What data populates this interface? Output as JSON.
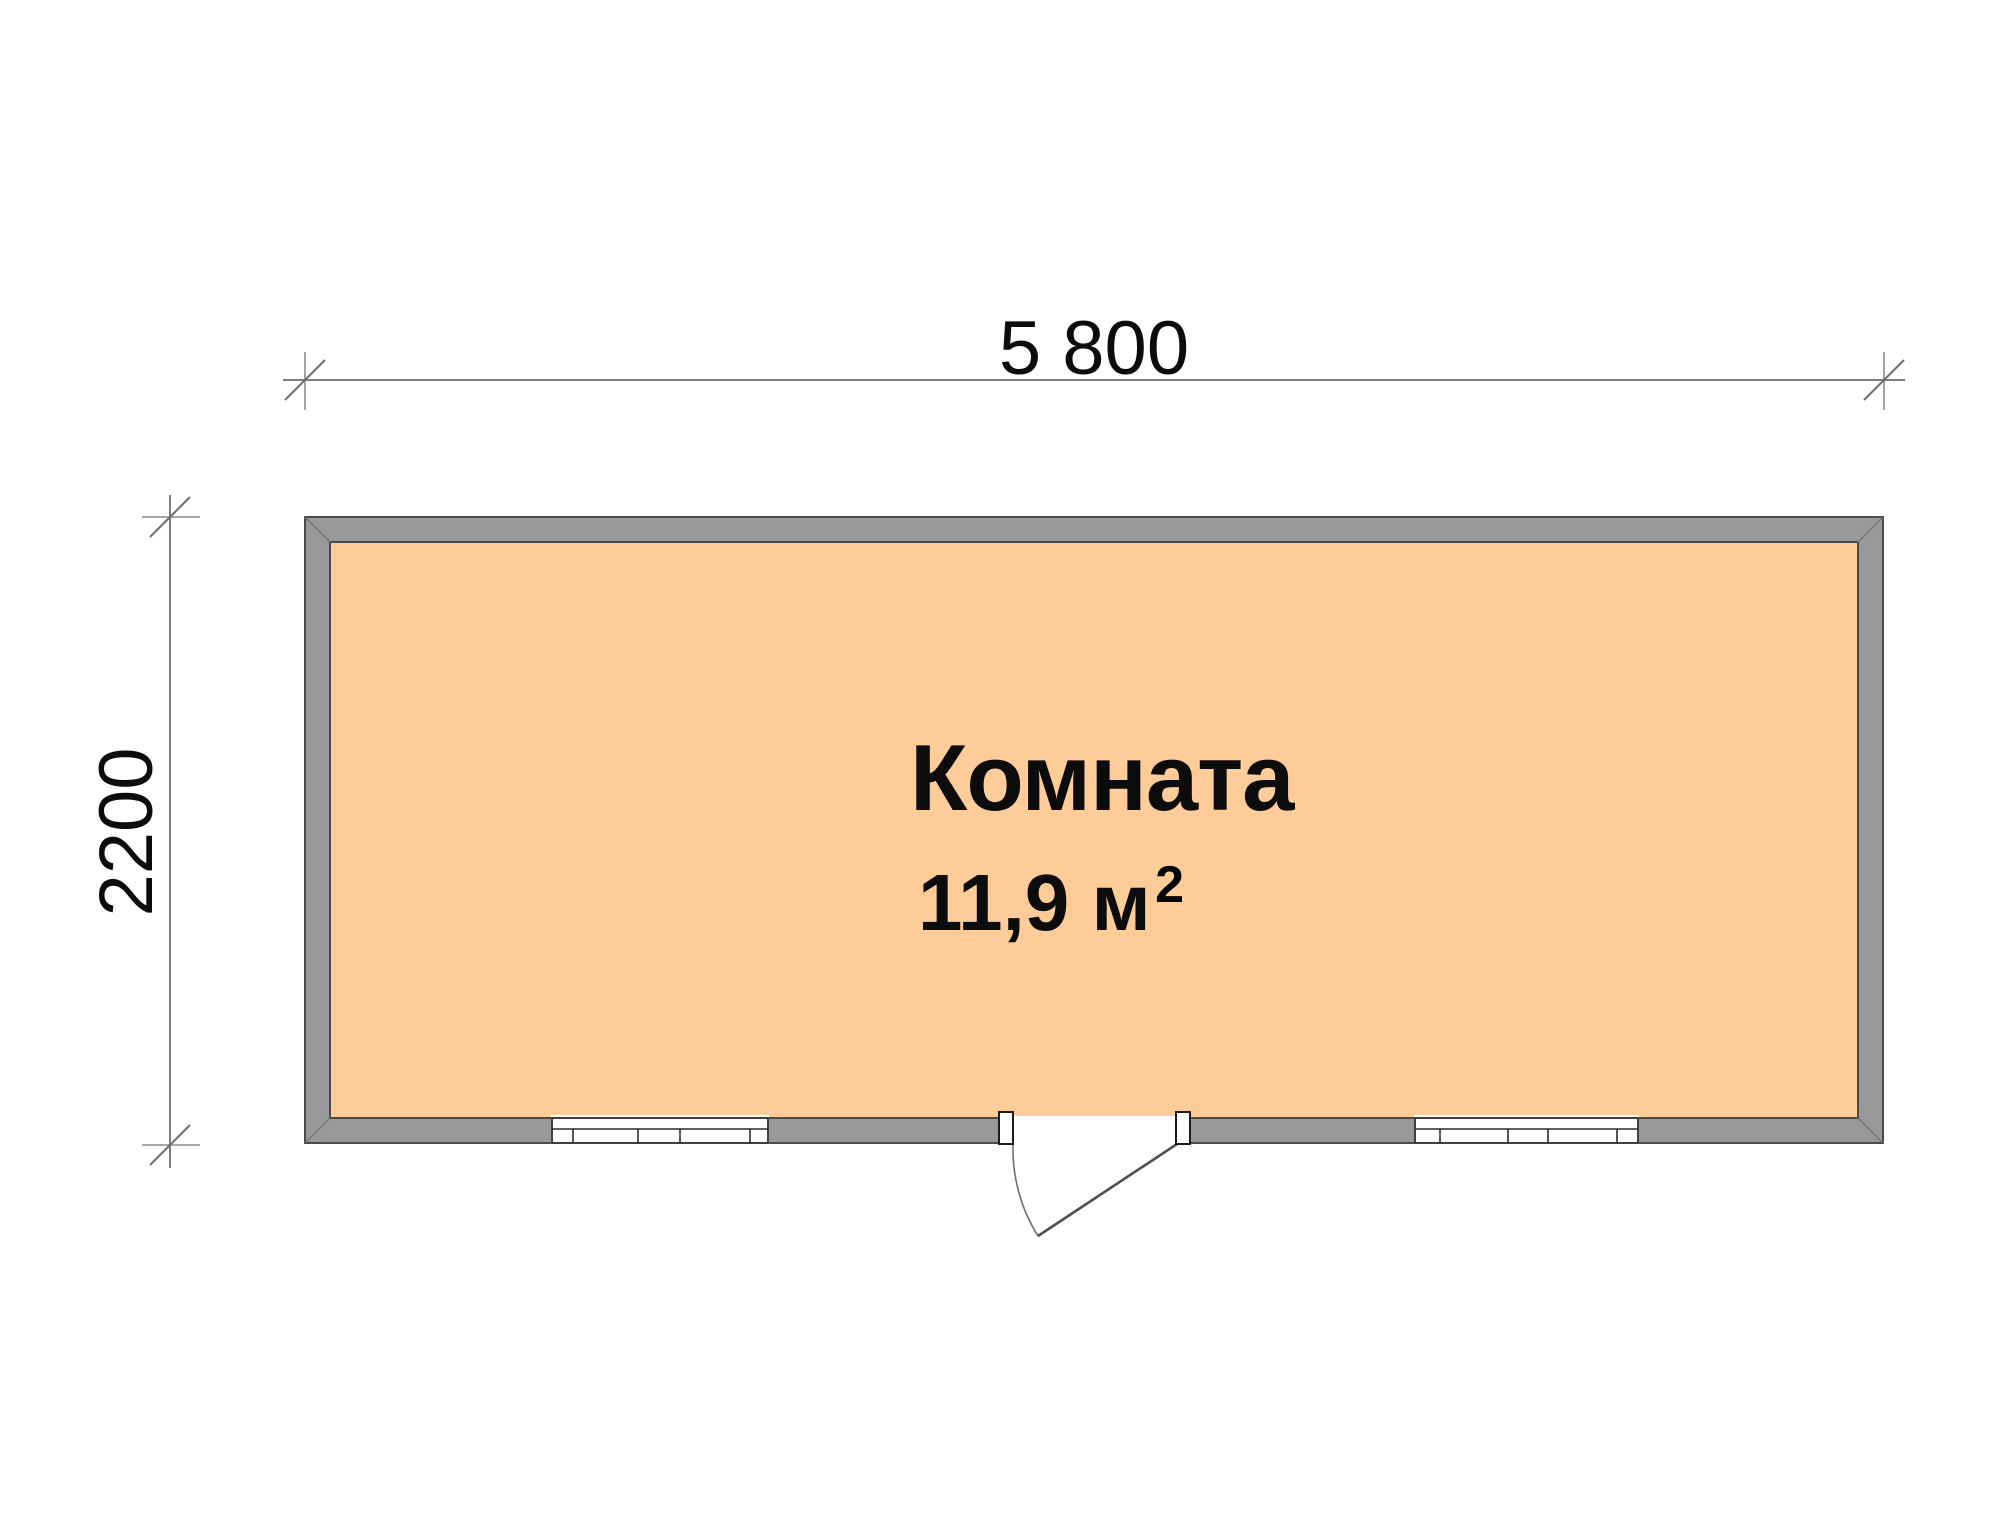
{
  "plan": {
    "title_hint": "floor plan of a single room cabin",
    "room": {
      "name": "Комната",
      "area_value": "11,9 м",
      "area_superscript": "2"
    },
    "dimensions": {
      "width_label": "5 800",
      "height_label": "2200"
    },
    "features": {
      "windows": [
        "window-left",
        "window-right"
      ],
      "door": "door-bottom-center-with-swing-arc"
    },
    "colors": {
      "background": "#FFFFFF",
      "room_fill": "#FECC99",
      "wall_fill": "#98999A",
      "wall_outline": "#4B4B4B",
      "window_frame": "#2B2B2B",
      "dimension_line": "#7C7C7C",
      "text": "#0C0C0C"
    }
  }
}
